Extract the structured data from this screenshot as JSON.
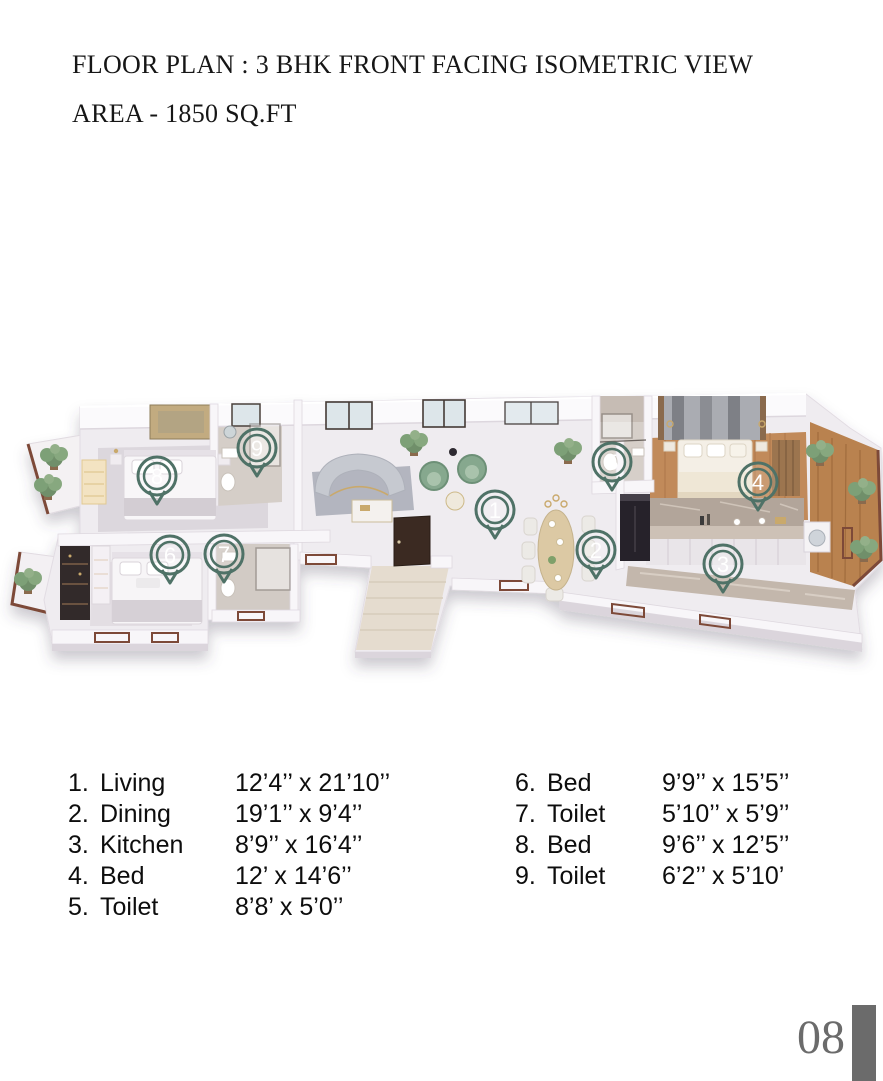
{
  "header": {
    "title": "FLOOR PLAN : 3 BHK FRONT FACING ISOMETRIC VIEW",
    "subtitle": "AREA - 1850 SQ.FT"
  },
  "footer": {
    "page_number": "08"
  },
  "plan": {
    "marker_color": "#4f7267",
    "marker_number_color": "#ffffff",
    "markers": [
      {
        "num": "1",
        "x": 495,
        "y": 158
      },
      {
        "num": "2",
        "x": 596,
        "y": 198
      },
      {
        "num": "3",
        "x": 723,
        "y": 212
      },
      {
        "num": "4",
        "x": 758,
        "y": 130
      },
      {
        "num": "5",
        "x": 612,
        "y": 110
      },
      {
        "num": "6",
        "x": 170,
        "y": 203
      },
      {
        "num": "7",
        "x": 224,
        "y": 202
      },
      {
        "num": "8",
        "x": 157,
        "y": 124
      },
      {
        "num": "9",
        "x": 257,
        "y": 96
      }
    ]
  },
  "legend": {
    "columns": [
      {
        "items": [
          {
            "num": "1.",
            "label": "Living",
            "dim": "12’4’’ x 21’10’’"
          },
          {
            "num": "2.",
            "label": "Dining",
            "dim": "19’1’’ x 9’4’’"
          },
          {
            "num": "3.",
            "label": "Kitchen",
            "dim": "8’9’’ x 16’4’’"
          },
          {
            "num": "4.",
            "label": "Bed",
            "dim": "12’ x 14’6’’"
          },
          {
            "num": "5.",
            "label": "Toilet",
            "dim": "8’8’ x 5’0’’"
          }
        ]
      },
      {
        "items": [
          {
            "num": "6.",
            "label": "Bed",
            "dim": "9’9’’ x 15’5’’"
          },
          {
            "num": "7.",
            "label": "Toilet",
            "dim": "5’10’’ x 5’9’’"
          },
          {
            "num": "8.",
            "label": "Bed",
            "dim": "9’6’’ x 12’5’’"
          },
          {
            "num": "9.",
            "label": "Toilet",
            "dim": "6’2’’ x 5’10’"
          }
        ]
      }
    ]
  }
}
